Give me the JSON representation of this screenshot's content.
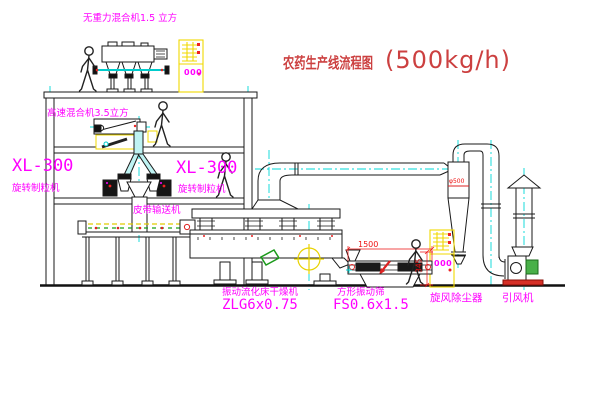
{
  "page": {
    "background": "#ffffff",
    "width": 600,
    "height": 403
  },
  "title": {
    "text_cn": "农药生产线流程图",
    "capacity": "(500kg/h)",
    "color": "#cc4040"
  },
  "labels": {
    "top_mixer": "无重力混合机1.5 立方",
    "mid_mixer": "高速混合机3.5立方",
    "left_granulator_model": "XL-300",
    "left_granulator_name": "旋转制粒机",
    "right_granulator_model": "XL-300",
    "right_granulator_name": "旋转制粒机",
    "belt_conveyor": "皮带输送机",
    "dryer_name": "振动流化床干燥机",
    "dryer_model": "ZLG6x0.75",
    "screen_name": "方形振动筛",
    "screen_model": "FS0.6x1.5",
    "cyclone_name": "旋风除尘器",
    "fan_name": "引风机"
  },
  "dimensions": {
    "screen_length": "1500",
    "screen_height": "345",
    "cyclone_marker": "φ500"
  },
  "control_cabinets": {
    "cabinet1_display": "000",
    "cabinet2_display": "000"
  },
  "figures": {
    "worker_count": "4"
  },
  "colors": {
    "label_magenta": "#ff00ff",
    "title_red": "#cc4040",
    "dimension_red": "#ee1111",
    "pipe_cyan": "#00d8d8",
    "cabinet_yellow": "#f0d800",
    "machine_line": "#1a1a1a",
    "belt_green": "#18a018",
    "motor_green": "#49b049",
    "base_red": "#d63027"
  }
}
